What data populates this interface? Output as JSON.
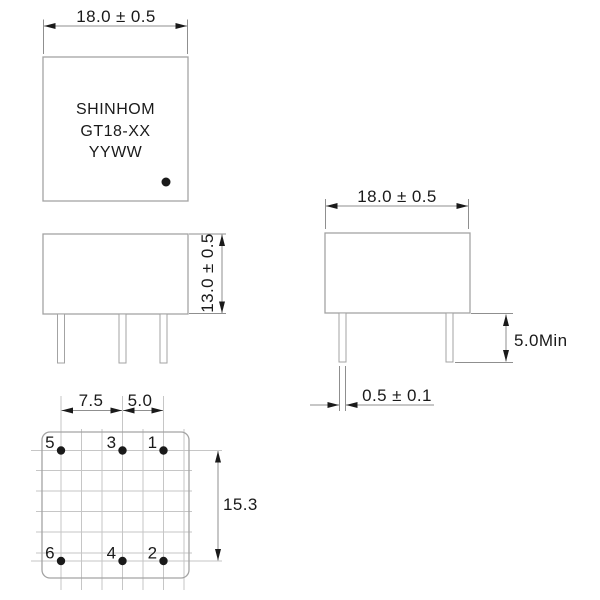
{
  "drawing": {
    "product": {
      "brand": "SHINHOM",
      "model": "GT18-XX",
      "date_code": "YYWW"
    },
    "top_view": {
      "width_dim": "18.0 ± 0.5"
    },
    "side_view": {
      "height_dim": "13.0 ± 0.5"
    },
    "front_view": {
      "width_dim": "18.0 ± 0.5",
      "pin_length_dim": "5.0Min",
      "pin_diameter_dim": "0.5 ± 0.1"
    },
    "bottom_view": {
      "pitch_a_dim": "7.5",
      "pitch_b_dim": "5.0",
      "row_spacing_dim": "15.3",
      "pins": [
        {
          "label": "5"
        },
        {
          "label": "3"
        },
        {
          "label": "1"
        },
        {
          "label": "6"
        },
        {
          "label": "4"
        },
        {
          "label": "2"
        }
      ]
    },
    "colors": {
      "outline": "#a3a3a3",
      "grid": "#c6c6c6",
      "dimension": "#8f8f8f",
      "ink": "#1a1a1a",
      "paper": "#ffffff"
    }
  }
}
